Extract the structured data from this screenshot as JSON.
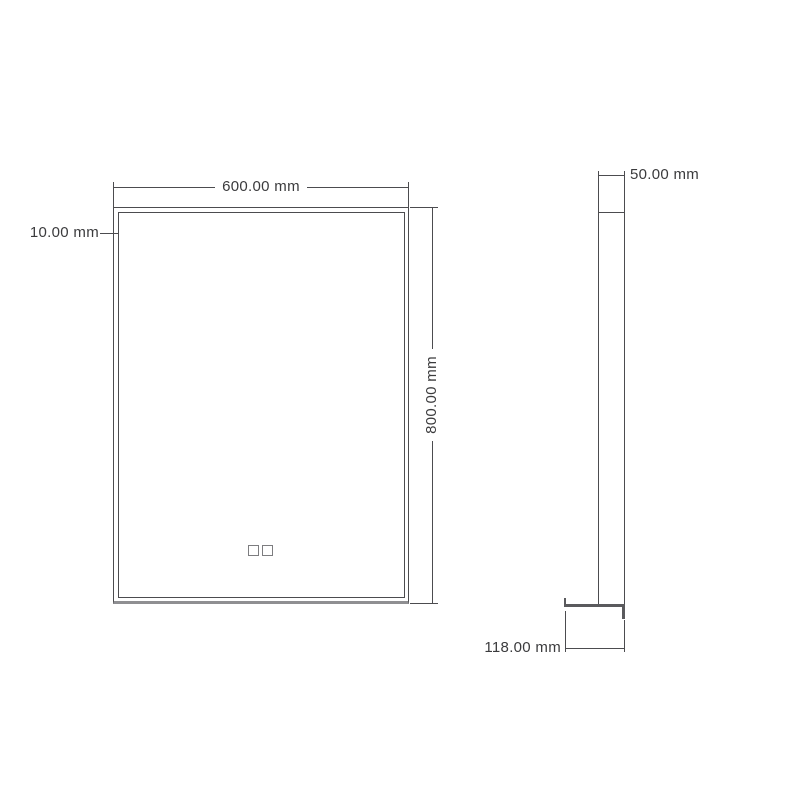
{
  "title": "Mirror dimensional drawing",
  "colors": {
    "background": "#ffffff",
    "line": "#4c4c4f",
    "thick_edge": "#8f8f92",
    "text": "#3b3b3d"
  },
  "front_view": {
    "width_dimension": "600.00 mm",
    "height_dimension": "800.00 mm",
    "frame_offset_dimension": "10.00 mm"
  },
  "side_view": {
    "depth_dimension": "50.00 mm",
    "base_depth_dimension": "118.00 mm"
  }
}
